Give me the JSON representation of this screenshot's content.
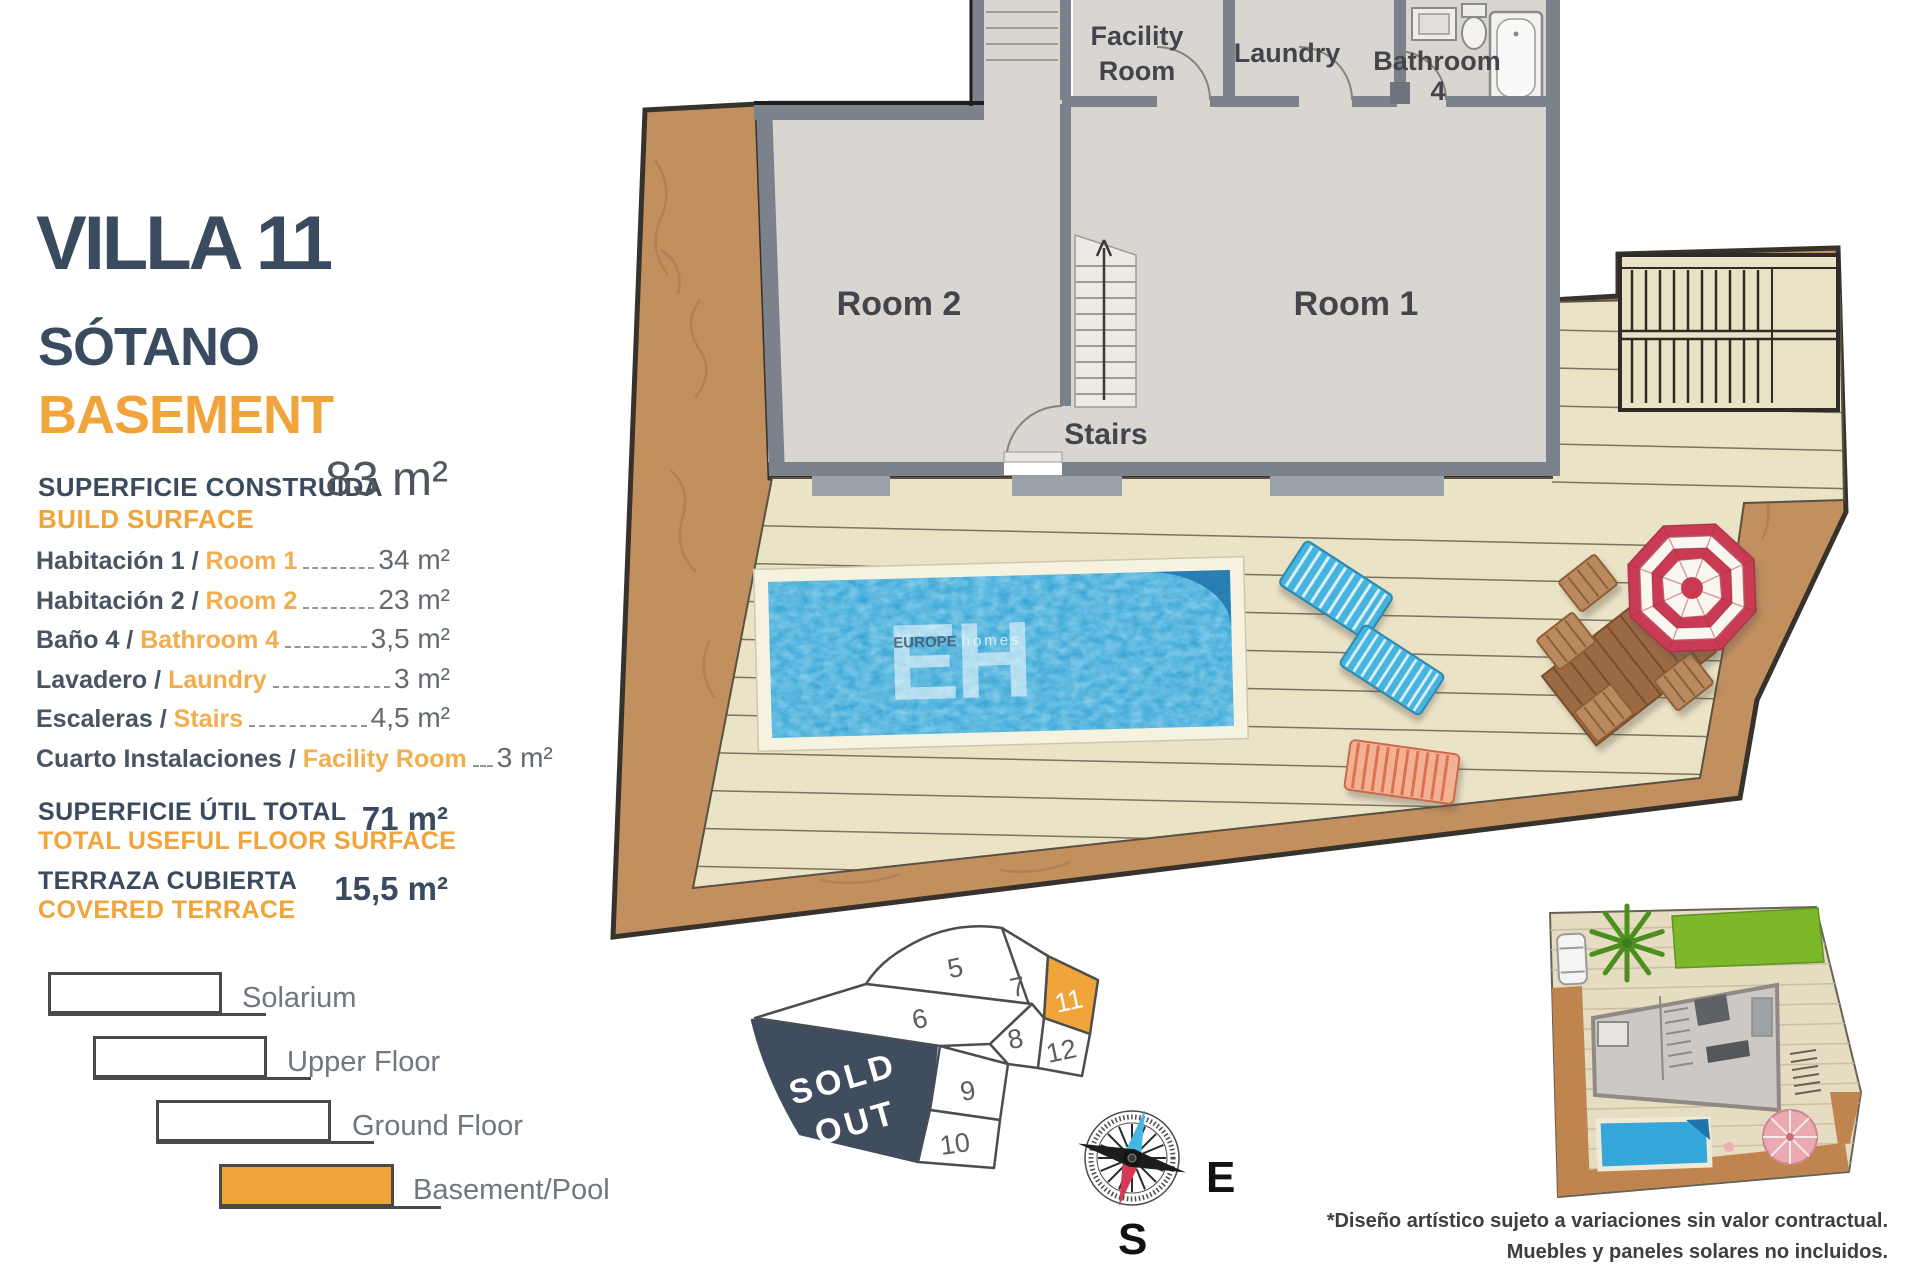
{
  "header": {
    "title": "VILLA 11",
    "subtitle_es": "SÓTANO",
    "subtitle_en": "BASEMENT"
  },
  "surface": {
    "build_label_es": "SUPERFICIE CONSTRUIDA",
    "build_label_en": "BUILD SURFACE",
    "build_value": "83 m²",
    "rows": [
      {
        "es": "Habitación 1 /",
        "en": "Room 1",
        "value": "34 m²"
      },
      {
        "es": "Habitación 2 /",
        "en": "Room 2",
        "value": "23 m²"
      },
      {
        "es": "Baño 4 /",
        "en": "Bathroom 4",
        "value": "3,5 m²"
      },
      {
        "es": "Lavadero /",
        "en": "Laundry",
        "value": "3 m²"
      },
      {
        "es": "Escaleras /",
        "en": "Stairs",
        "value": "4,5 m²"
      },
      {
        "es": "Cuarto Instalaciones /",
        "en": "Facility Room",
        "value": "3 m²"
      }
    ],
    "useful_label_es": "SUPERFICIE ÚTIL TOTAL",
    "useful_label_en": "TOTAL USEFUL FLOOR SURFACE",
    "useful_value": "71 m²",
    "terrace_label_es": "TERRAZA CUBIERTA",
    "terrace_label_en": "COVERED TERRACE",
    "terrace_value": "15,5 m²"
  },
  "legend": {
    "items": [
      {
        "label": "Solarium",
        "highlighted": false
      },
      {
        "label": "Upper Floor",
        "highlighted": false
      },
      {
        "label": "Ground Floor",
        "highlighted": false
      },
      {
        "label": "Basement/Pool",
        "highlighted": true
      }
    ]
  },
  "plan": {
    "room1": "Room 1",
    "room2": "Room 2",
    "stairs": "Stairs",
    "facility_line1": "Facility",
    "facility_line2": "Room",
    "laundry": "Laundry",
    "bathroom_line1": "Bathroom",
    "bathroom_line2": "4"
  },
  "watermark": {
    "initials": "EH",
    "brand_bold": "EUROPE",
    "brand_light": "homes"
  },
  "site_map": {
    "plots": [
      "5",
      "7",
      "11",
      "6",
      "8",
      "12",
      "9",
      "10"
    ],
    "highlighted_plot": "11",
    "sold_line1": "SOLD",
    "sold_line2": "OUT"
  },
  "compass": {
    "east": "E",
    "south": "S"
  },
  "disclaimer": {
    "line1": "*Diseño artístico sujeto a variaciones sin valor contractual.",
    "line2": "Muebles y paneles solares no incluidos."
  },
  "colors": {
    "accent_orange": "#F0A43A",
    "navy": "#3A4B5F",
    "sold_out_navy": "#3F4D5E",
    "terrain_brown": "#C28F5F",
    "deck_beige": "#EBE3C6",
    "pool_blue": "#2B9FD3"
  }
}
